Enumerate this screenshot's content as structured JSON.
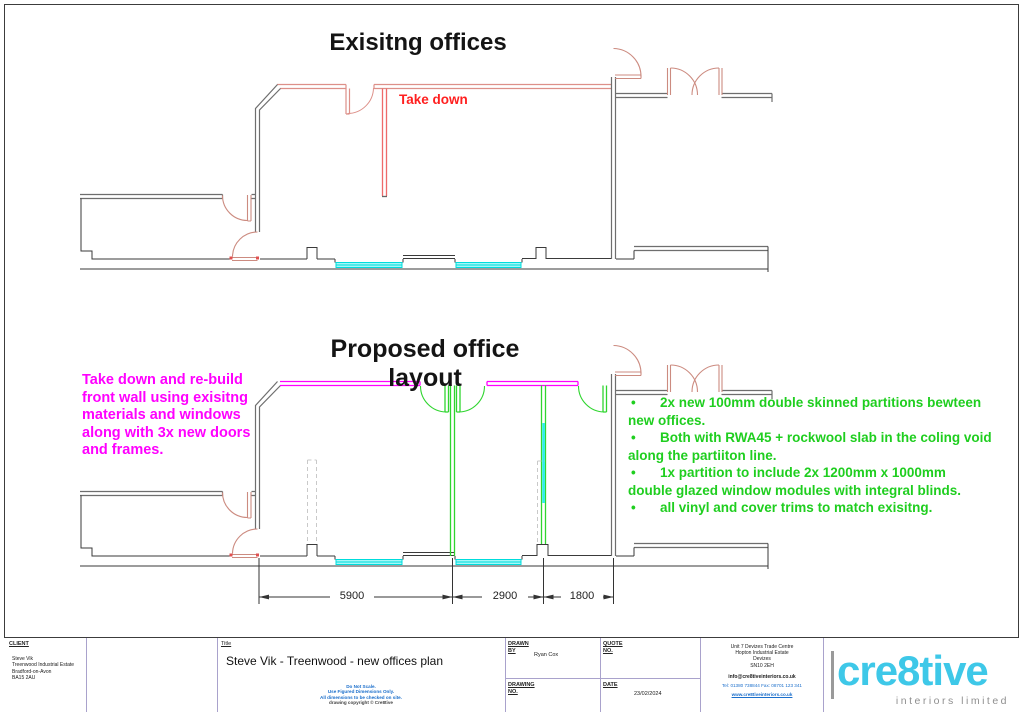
{
  "drawing": {
    "existing_title": "Exisitng offices",
    "proposed_title": "Proposed office layout",
    "take_down_label": "Take down",
    "magenta_note": [
      "Take down and re-build",
      "front wall using exisitng",
      "materials and windows",
      "along with 3x new doors",
      "and frames."
    ],
    "green_notes": [
      {
        "bullet": "•",
        "line1": "2x new 100mm double skinned partitions bewteen",
        "line2": "new offices."
      },
      {
        "bullet": "•",
        "line1": "Both with RWA45 + rockwool slab in the coling void",
        "line2": "along the partiiton line."
      },
      {
        "bullet": "•",
        "line1": "1x partition to include 2x 1200mm x 1000mm",
        "line2": "double glazed window modules with integral blinds."
      },
      {
        "bullet": "•",
        "line1": "all vinyl and cover trims to match exisitng.",
        "line2": ""
      }
    ],
    "dimensions": {
      "d1": "5900",
      "d2": "2900",
      "d3": "1800"
    }
  },
  "title_block": {
    "client_label": "CLIENT",
    "client_lines": [
      "Steve Vik",
      "Treenwood Industrial Estate",
      "Bradford-on-Avon",
      "BA15 2AU"
    ],
    "title_label": "Title",
    "title": "Steve Vik - Treenwood -  new offices plan",
    "disclaimer": [
      "Do Not Scale.",
      "Use Figured Dimensions Only.",
      "All dimensions to be checked on site.",
      "drawing copyright © Cre8tive"
    ],
    "drawn_label": "DRAWN\nBY",
    "drawn_by": "Ryan Cox",
    "drawing_no_label": "DRAWING\nNO.",
    "quote_label": "QUOTE\nNO.",
    "date_label": "DATE",
    "date": "23/02/2024",
    "address_lines": [
      "Unit 7 Devizes Trade Centre",
      "Hopton Industrial Estate",
      "Devizes",
      "SN10 2EH"
    ],
    "email": "info@cre8tiveinteriors.co.uk",
    "tel_fax": "Tel: 01380 738844   Fax: 08701 123 341",
    "website": "www.cre8tiveinteriors.co.uk",
    "logo_text": "cre8tive",
    "logo_subtext": "interiors limited"
  },
  "colors": {
    "magenta_new_wall": "#FF00FF",
    "green_partition": "#2FD52F",
    "red_take_down": "#FF1F1F",
    "coral_existing": "#CC8B80",
    "window_cyan": "#00DCDC",
    "logo_cyan": "#3EC8E8",
    "disclaimer_blue": "#1A6ECB"
  }
}
